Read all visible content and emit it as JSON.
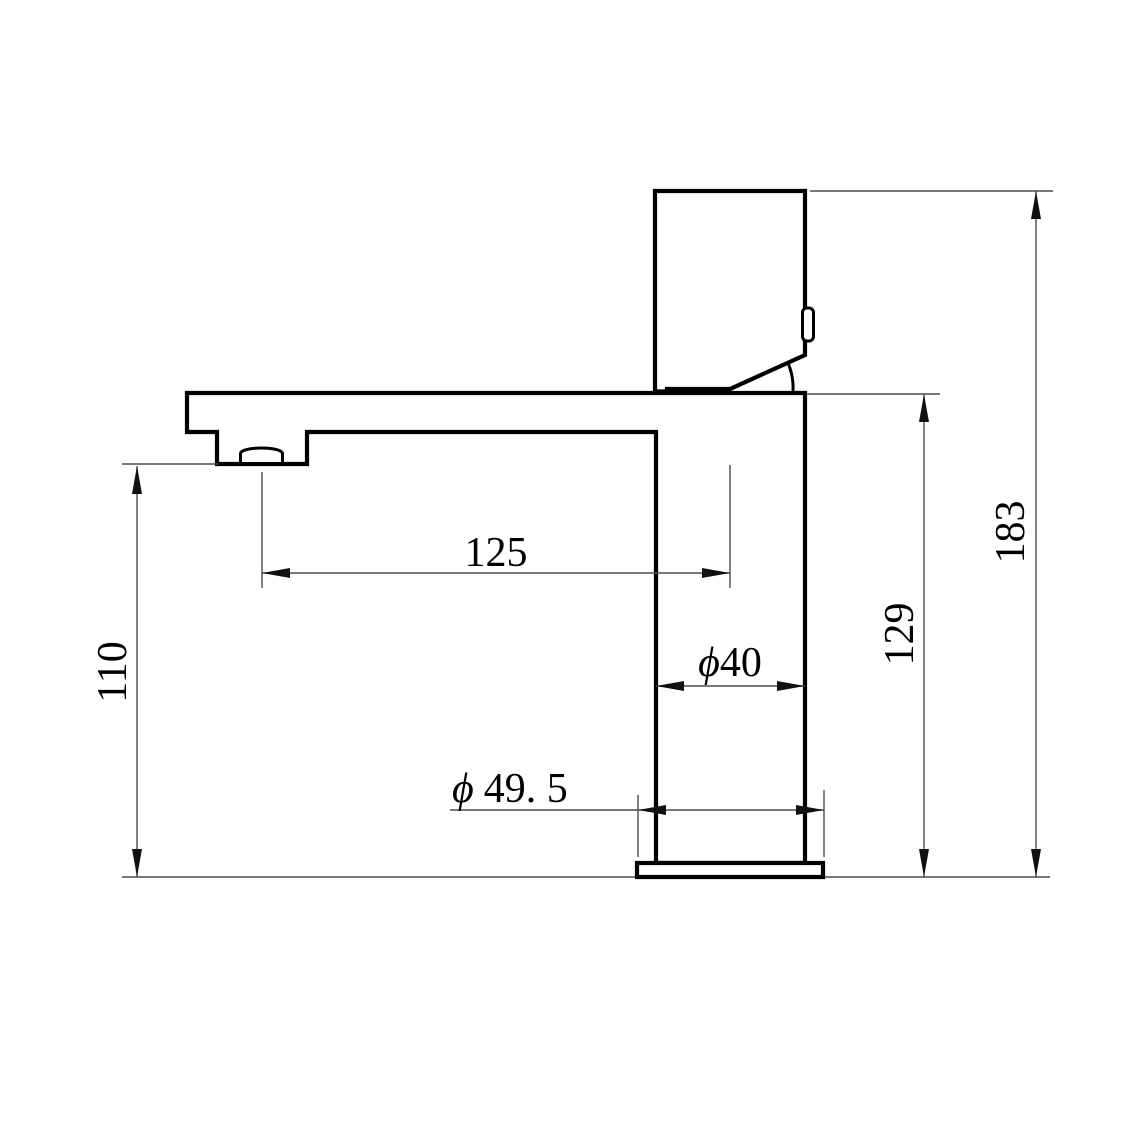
{
  "drawing": {
    "title": "faucet-side-elevation",
    "subject": "single-lever basin mixer tap, side view technical drawing",
    "units": "mm",
    "colors": {
      "outline": "#000000",
      "dimension_line": "#4d4d4d",
      "background": "#ffffff"
    },
    "dimensions": {
      "spout_height": {
        "value": "110",
        "orientation": "vertical",
        "description": "height from counter to spout outlet"
      },
      "spout_reach": {
        "value": "125",
        "orientation": "horizontal",
        "description": "spout outlet to body centerline"
      },
      "body_height": {
        "value": "129",
        "orientation": "vertical",
        "description": "counter to top of spout body"
      },
      "total_height": {
        "value": "183",
        "orientation": "vertical",
        "description": "counter to top of handle"
      },
      "body_diameter": {
        "symbol": "ϕ",
        "value": "40",
        "description": "body column diameter"
      },
      "base_diameter": {
        "symbol": "ϕ",
        "value": "49. 5",
        "description": "base flange diameter"
      }
    }
  }
}
